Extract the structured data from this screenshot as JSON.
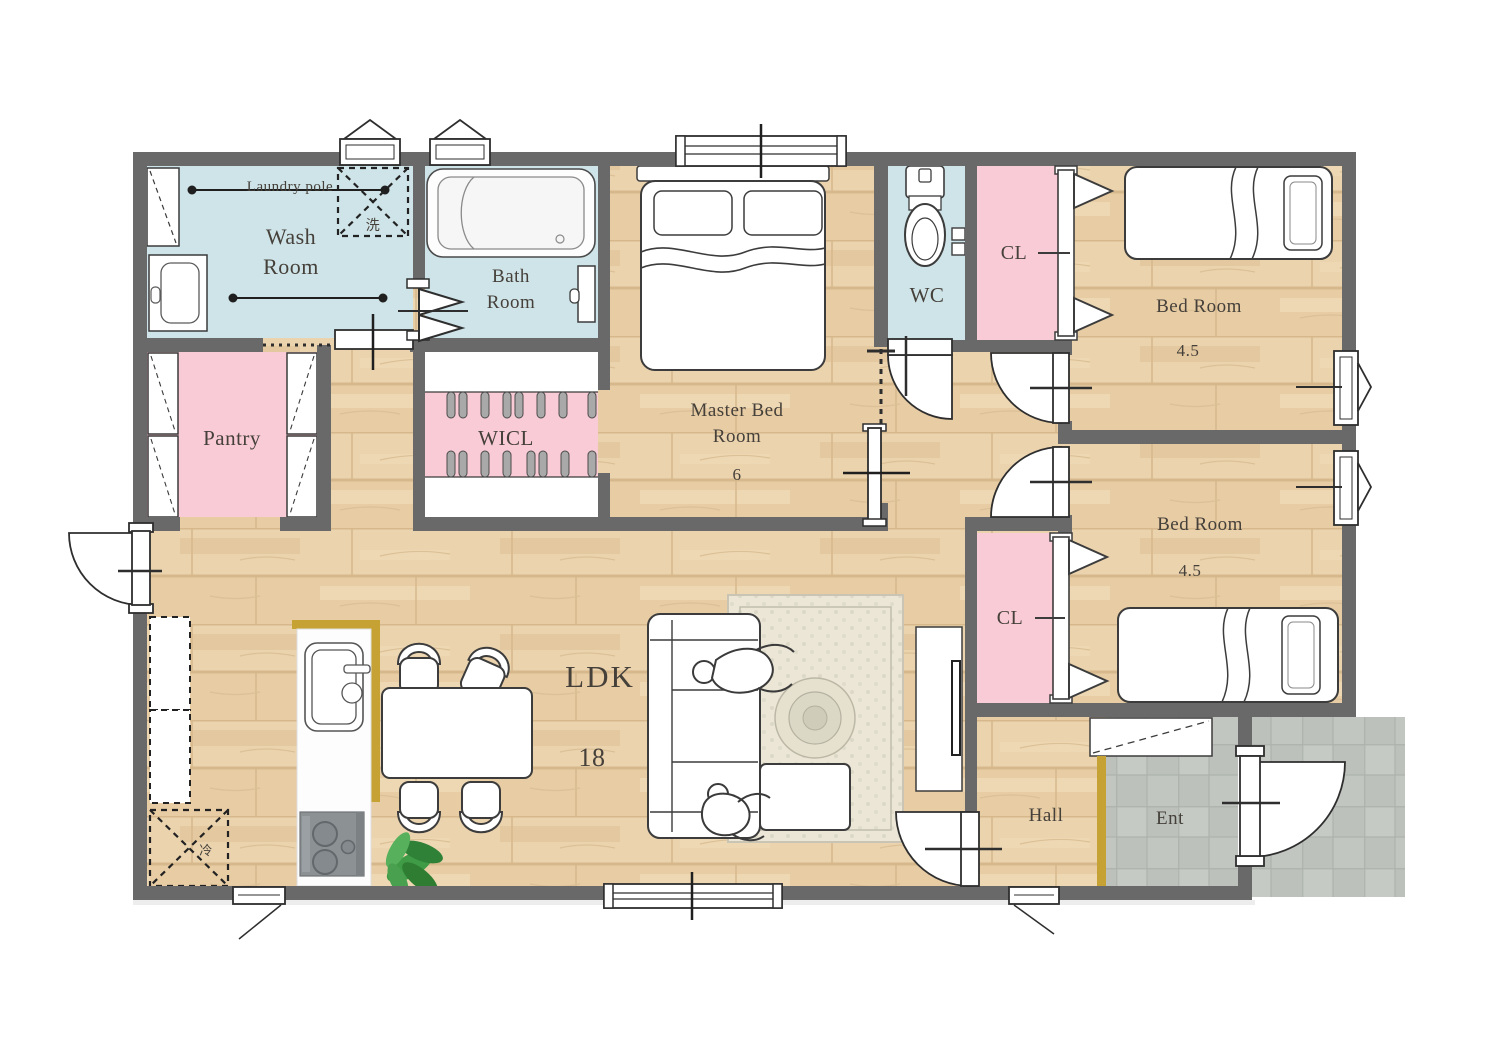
{
  "plan": {
    "title": "3LDK one-story floor plan",
    "rooms": {
      "wash_room": {
        "label": "Wash Room"
      },
      "bath_room": {
        "label": "Bath Room"
      },
      "pantry": {
        "label": "Pantry"
      },
      "wicl": {
        "label": "WICL"
      },
      "master_bedroom": {
        "label": "Master Bed Room",
        "size": "6"
      },
      "wc": {
        "label": "WC"
      },
      "closet_1": {
        "label": "CL"
      },
      "bedroom_1": {
        "label": "Bed Room",
        "size": "4.5"
      },
      "bedroom_2": {
        "label": "Bed Room",
        "size": "4.5"
      },
      "closet_2": {
        "label": "CL"
      },
      "ldk": {
        "label": "LDK",
        "size": "18"
      },
      "hall": {
        "label": "Hall"
      },
      "entrance": {
        "label": "Ent"
      }
    },
    "annotations": {
      "laundry_pole": "Laundry pole",
      "washing_machine": "洗",
      "refrigerator": "冷"
    },
    "colors": {
      "wall": "#696969",
      "water_rooms": "#cfe4e8",
      "closet_pink": "#f9cbd6",
      "wood_floor": "#e9d0ab",
      "tile_gray": "#bdc1bc",
      "accent_gold": "#c5a233",
      "text": "#45403a",
      "plant_green": "#3f9b45"
    }
  }
}
